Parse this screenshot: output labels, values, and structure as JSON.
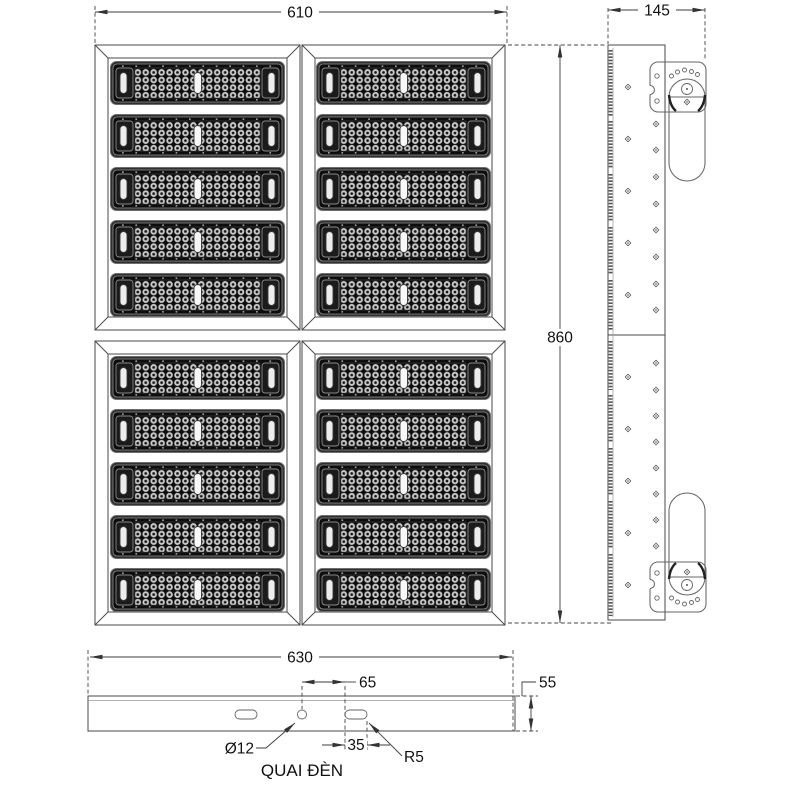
{
  "dimensions": {
    "front_width": "610",
    "side_depth": "145",
    "front_height": "860",
    "bar_width": "630",
    "hole_to_slot_offset": "65",
    "bar_height": "55",
    "hole_diameter": "Ø12",
    "slot_width": "35",
    "slot_corner_radius": "R5"
  },
  "labels": {
    "bottom_bar_name": "QUAI ĐÈN"
  },
  "structure": {
    "quadrants": 4,
    "led_modules_per_quadrant": 5
  },
  "colors": {
    "line": "#4a4a4a",
    "dim_line": "#3d3d3d",
    "text": "#111111",
    "module_frame": "#303030",
    "module_face": "#0d0d0d",
    "led_dot": "#c9c9c9",
    "background": "#ffffff"
  }
}
